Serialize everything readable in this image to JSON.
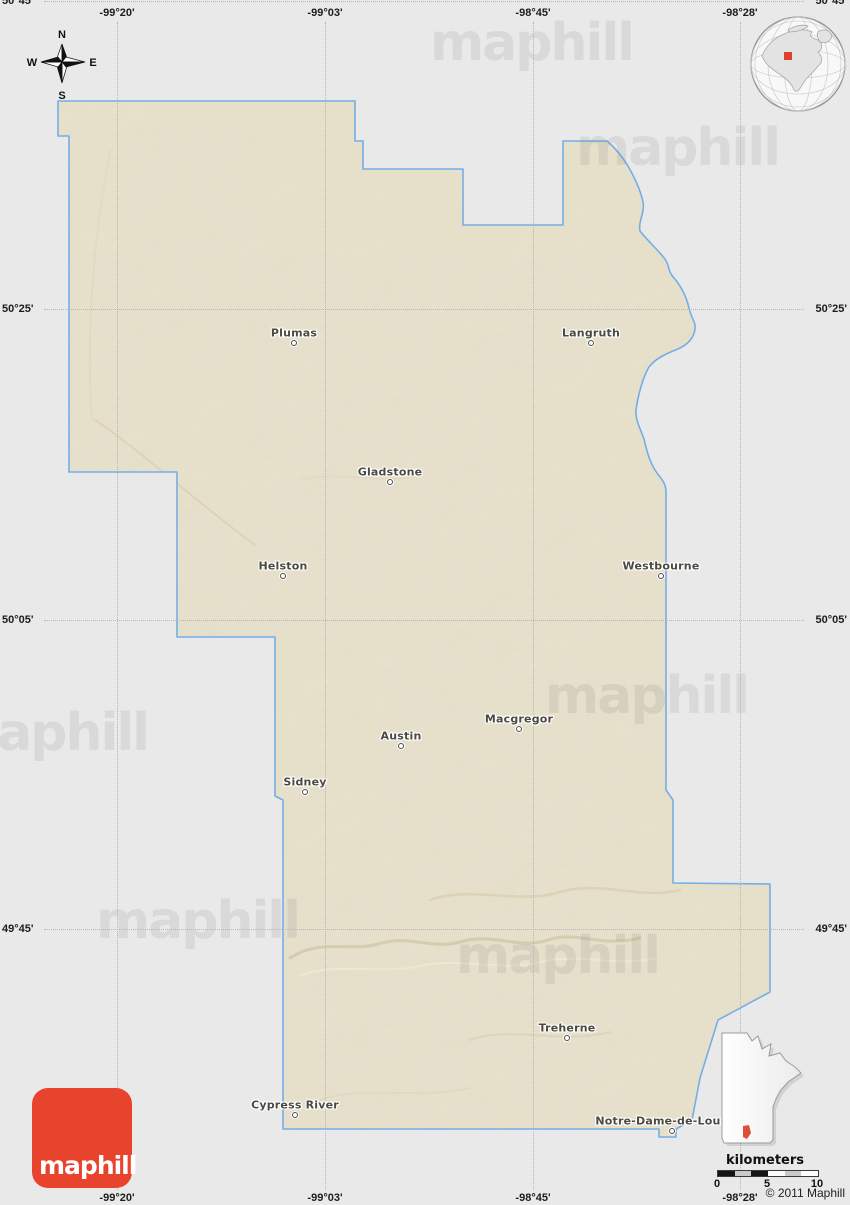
{
  "brand": {
    "logo_text": "maphill",
    "watermark_text": "maphill",
    "copyright": "© 2011 Maphill"
  },
  "compass": {
    "north": "N",
    "south": "S",
    "east": "E",
    "west": "W"
  },
  "grid": {
    "meridians": [
      {
        "label": "-99°20'",
        "x": 117
      },
      {
        "label": "-99°03'",
        "x": 325
      },
      {
        "label": "-98°45'",
        "x": 533
      },
      {
        "label": "-98°28'",
        "x": 740
      }
    ],
    "parallels": [
      {
        "label": "50°45'",
        "y": 1
      },
      {
        "label": "50°25'",
        "y": 309
      },
      {
        "label": "50°05'",
        "y": 620
      },
      {
        "label": "49°45'",
        "y": 929
      }
    ]
  },
  "places": [
    {
      "name": "Plumas",
      "x": 294,
      "y": 333
    },
    {
      "name": "Langruth",
      "x": 591,
      "y": 333
    },
    {
      "name": "Gladstone",
      "x": 390,
      "y": 472
    },
    {
      "name": "Helston",
      "x": 283,
      "y": 566
    },
    {
      "name": "Westbourne",
      "x": 661,
      "y": 566
    },
    {
      "name": "Macgregor",
      "x": 519,
      "y": 719
    },
    {
      "name": "Austin",
      "x": 401,
      "y": 736
    },
    {
      "name": "Sidney",
      "x": 305,
      "y": 782
    },
    {
      "name": "Treherne",
      "x": 567,
      "y": 1028
    },
    {
      "name": "Cypress River",
      "x": 295,
      "y": 1105
    },
    {
      "name": "Notre-Dame-de-Lourdes",
      "x": 672,
      "y": 1121
    }
  ],
  "scalebar": {
    "title": "kilometers",
    "ticks": [
      {
        "label": "0",
        "x": 4
      },
      {
        "label": "5",
        "x": 54
      },
      {
        "label": "10",
        "x": 104
      }
    ]
  },
  "watermarks": [
    {
      "x": 430,
      "y": 13
    },
    {
      "x": 576,
      "y": 118
    },
    {
      "x": 545,
      "y": 666
    },
    {
      "x": -55,
      "y": 703
    },
    {
      "x": 96,
      "y": 891
    },
    {
      "x": 456,
      "y": 926
    }
  ],
  "colors": {
    "background": "#e9e9e9",
    "map_fill": "#e5dec6",
    "map_border": "#73aee6",
    "logo_red": "#e8432d",
    "inset_marker_red": "#dd4f38",
    "globe_marker_red": "#e0402e"
  }
}
